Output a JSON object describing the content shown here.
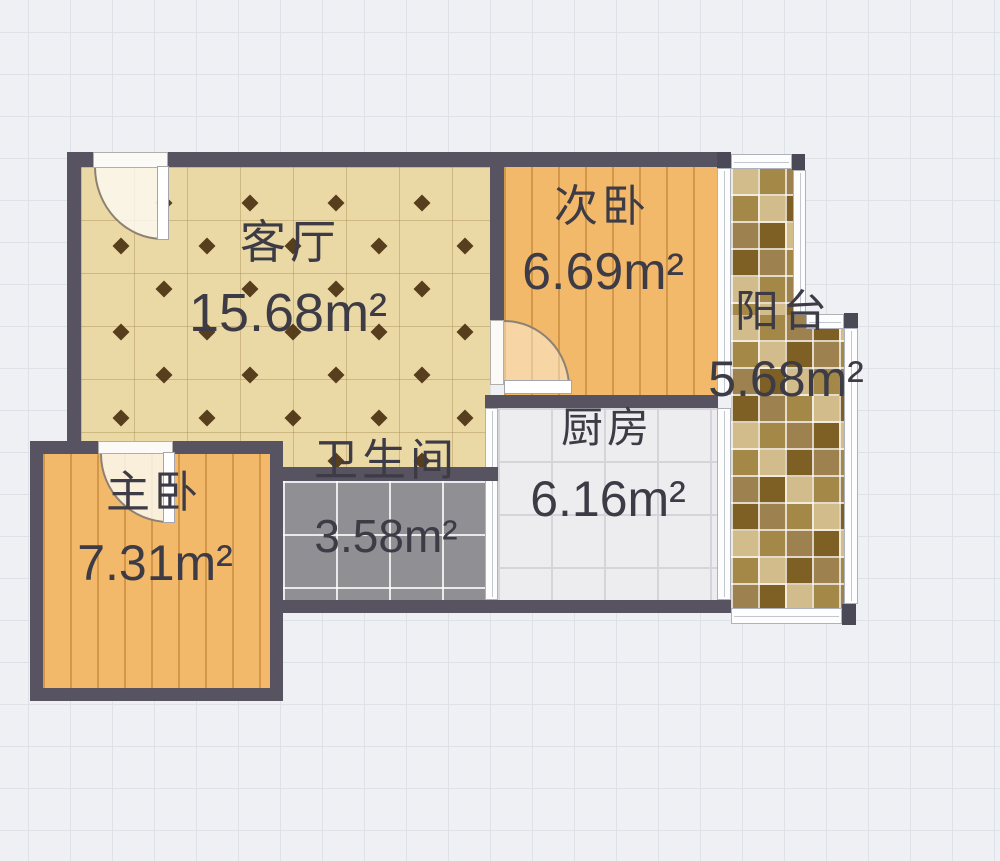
{
  "rooms": [
    {
      "id": "living",
      "name": "客厅",
      "area": "15.68m²"
    },
    {
      "id": "second-bedroom",
      "name": "次卧",
      "area": "6.69m²"
    },
    {
      "id": "balcony",
      "name": "阳台",
      "area": "5.68m²"
    },
    {
      "id": "kitchen",
      "name": "厨房",
      "area": "6.16m²"
    },
    {
      "id": "bathroom",
      "name": "卫生间",
      "area": "3.58m²"
    },
    {
      "id": "master-bedroom",
      "name": "主卧",
      "area": "7.31m²"
    }
  ],
  "colors": {
    "background": "#eef0f4",
    "wall": "#575361",
    "living_floor": "#ead9a4",
    "bedroom_floor": "#f2b96b",
    "bathroom_floor": "#8f8f94",
    "kitchen_floor": "#ededf0",
    "balcony_tile_dark": "#9a7a33",
    "balcony_tile_light": "#cdb47e"
  }
}
